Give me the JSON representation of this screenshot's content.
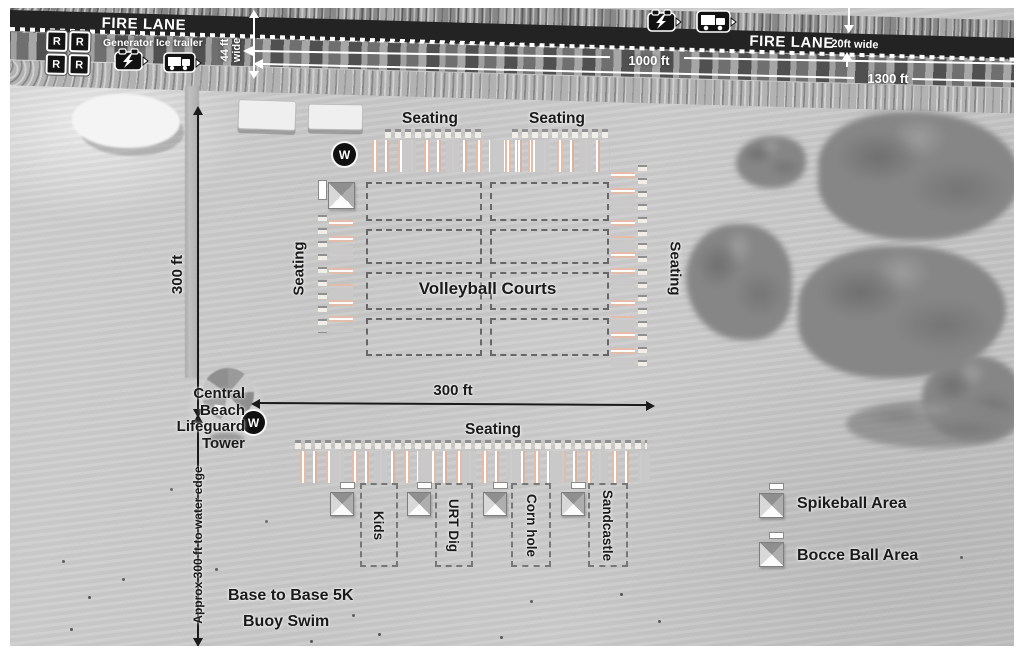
{
  "colors": {
    "fire_lane_band": "#232323",
    "sand": "#c9c9c9",
    "seating_stripe": "#e4bcaa",
    "label_text": "#1a1a1a"
  },
  "fire_lane": {
    "left_label": "FIRE LANE",
    "right_label": "FIRE LANE",
    "right_width_note": "20ft wide",
    "lane_width_line1": "44 ft",
    "lane_width_line2": "wide",
    "restroom_letter": "R",
    "generator_label": "Generator",
    "ice_trailer_label": "Ice trailer",
    "dim_1000": "1000 ft",
    "dim_1300": "1300 ft"
  },
  "dims": {
    "vertical_300": "300 ft",
    "horizontal_300": "300 ft",
    "water_edge_note": "Approx 300 ft to water edge"
  },
  "labels": {
    "seating": "Seating",
    "volleyball_courts": "Volleyball Courts",
    "water_station": "W",
    "lifeguard_line1": "Central",
    "lifeguard_line2": "Beach",
    "lifeguard_line3": "Lifeguard",
    "lifeguard_line4": "Tower",
    "base_to_base": "Base to Base 5K",
    "buoy_swim": "Buoy Swim"
  },
  "activities": [
    {
      "name": "Kids"
    },
    {
      "name": "URT Dig"
    },
    {
      "name": "Corn hole"
    },
    {
      "name": "Sandcastle"
    }
  ],
  "legend": [
    {
      "label": "Spikeball Area"
    },
    {
      "label": "Bocce Ball Area"
    }
  ]
}
